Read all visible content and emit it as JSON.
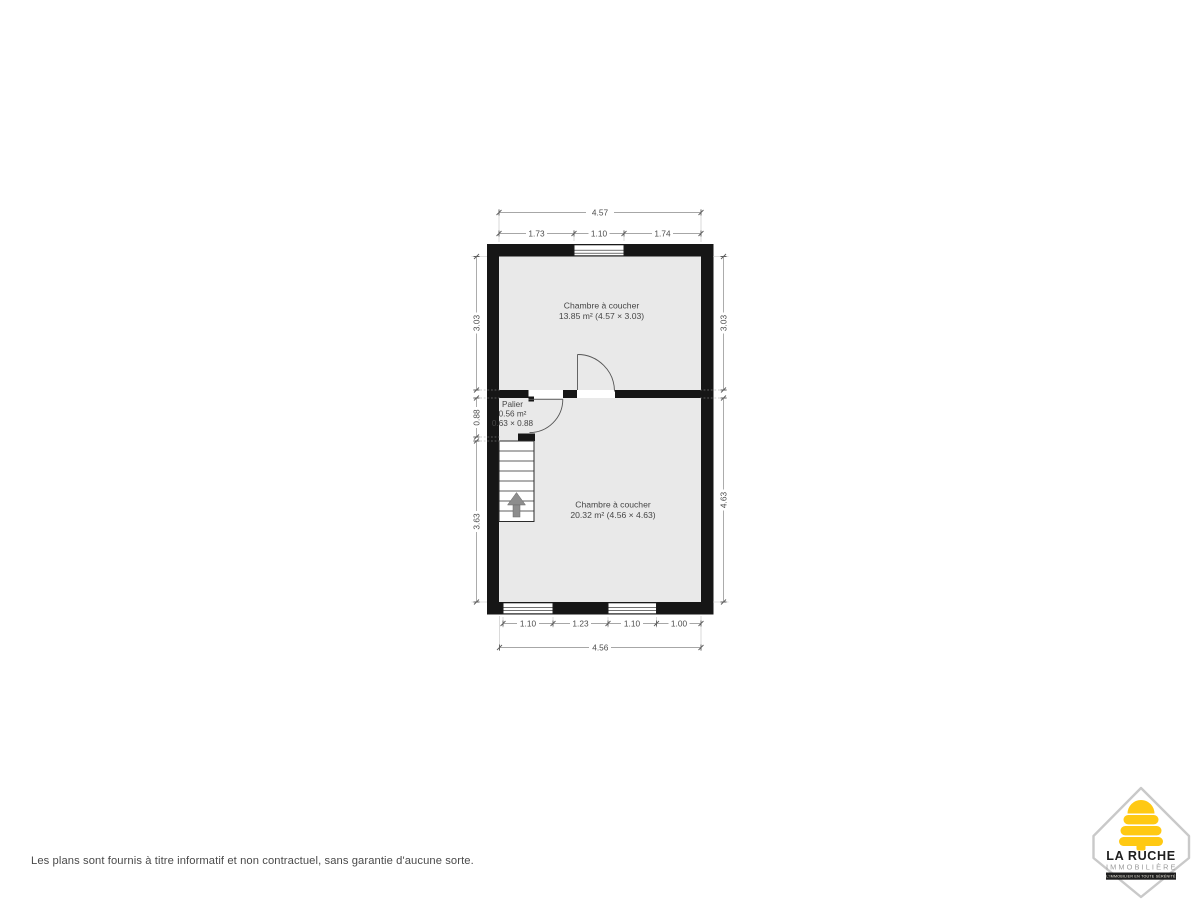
{
  "plan": {
    "rooms": [
      {
        "name": "Chambre à coucher",
        "detail": "13.85 m² (4.57 × 3.03)"
      },
      {
        "name": "Chambre à coucher",
        "detail": "20.32 m² (4.56 × 4.63)"
      },
      {
        "name": "Palier",
        "area": "0.56 m²",
        "size": "0.63 × 0.88"
      }
    ],
    "dims": {
      "top_total": "4.57",
      "top_segments": [
        "1.73",
        "1.10",
        "1.74"
      ],
      "left": [
        "3.03",
        "0.88",
        "3.63"
      ],
      "right": [
        "3.03",
        "4.63"
      ],
      "bottom_segments": [
        "1.10",
        "1.23",
        "1.10",
        "1.00"
      ],
      "bottom_total": "4.56"
    },
    "colors": {
      "wall": "#161616",
      "room_fill": "#e9e9e9",
      "dim_text": "#4c4c4c"
    }
  },
  "footer": {
    "disclaimer": "Les plans sont fournis à titre informatif et non contractuel, sans garantie d'aucune sorte."
  },
  "logo": {
    "title": "LA RUCHE",
    "subtitle": "IMMOBILIÈRE",
    "tagline": "- L'IMMOBILIER EN TOUTE SÉRÉNITÉ -",
    "hive_color": "#FFC913",
    "ink": "#1f1f1f",
    "border": "#c9c9c9"
  }
}
